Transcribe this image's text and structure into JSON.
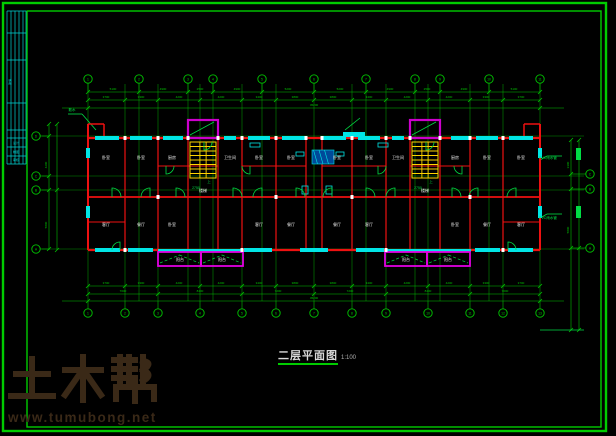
{
  "title": {
    "text": "二层平面图",
    "scale": "1:100"
  },
  "watermark": {
    "brand": "土木帮",
    "url": "www.tumubong.net",
    "color": "#3a2917"
  },
  "colors": {
    "frame": "#00cc00",
    "axis": "#00a800",
    "dim": "#00c400",
    "wall": "#ee1111",
    "window": "#00e5e5",
    "stair": "#ffd400",
    "shaft": "#cc00cc",
    "balcony": "#e000e0",
    "label": "#e8e8e8",
    "anno": "#00dd44",
    "titleblock": "#00d5d5",
    "hatch_fill": "#004a99"
  },
  "frame": {
    "outer": [
      3,
      3,
      603,
      428
    ],
    "inner": [
      27,
      11,
      574,
      416
    ]
  },
  "titleblock": {
    "x1": 7,
    "x2": 26,
    "vx": [
      7,
      11,
      15,
      19,
      23,
      26
    ],
    "hy": [
      11,
      33,
      60,
      103,
      130,
      138,
      147,
      156,
      164
    ],
    "texts": [
      {
        "x": 16,
        "y": 144,
        "t": "设计"
      },
      {
        "x": 16,
        "y": 153,
        "t": "制图"
      },
      {
        "x": 16,
        "y": 161,
        "t": "审核"
      },
      {
        "x": 11,
        "y": 82,
        "t": "建施",
        "rot": -90
      }
    ]
  },
  "axes": {
    "v": [
      88,
      125,
      139,
      158,
      188,
      200,
      213,
      242,
      262,
      276,
      314,
      352,
      366,
      386,
      415,
      428,
      440,
      470,
      489,
      503,
      540
    ],
    "v_y1": 84,
    "v_y2": 301,
    "h": [
      136,
      176,
      190,
      249
    ],
    "h_x1": 42,
    "h_x2": 584
  },
  "bubbles": {
    "top": {
      "cy": 79,
      "x": [
        88,
        139,
        188,
        213,
        262,
        314,
        366,
        415,
        440,
        489,
        540
      ],
      "n": [
        "1",
        "2",
        "3",
        "4",
        "5",
        "6",
        "7",
        "8",
        "9",
        "10",
        "11"
      ]
    },
    "bottom": {
      "cy": 313,
      "x": [
        88,
        125,
        158,
        200,
        242,
        276,
        314,
        352,
        386,
        428,
        470,
        503,
        540
      ],
      "n": [
        "1",
        "2",
        "3",
        "4",
        "5",
        "6",
        "7",
        "8",
        "9",
        "10",
        "11",
        "12",
        "13"
      ]
    },
    "left": {
      "cx": 36,
      "y": [
        136,
        176,
        190,
        249
      ],
      "n": [
        "D",
        "C",
        "B",
        "A"
      ]
    },
    "right": {
      "cx": 590,
      "y": [
        174,
        189,
        248
      ],
      "n": [
        "C",
        "B",
        "A"
      ]
    }
  },
  "dims": {
    "h": [
      {
        "y": 92,
        "x1": 88,
        "x2": 540,
        "ticks": [
          88,
          139,
          188,
          213,
          262,
          314,
          366,
          415,
          440,
          489,
          540
        ]
      },
      {
        "y": 100,
        "x1": 88,
        "x2": 540,
        "ticks": [
          88,
          125,
          158,
          200,
          242,
          276,
          314,
          352,
          386,
          428,
          470,
          503,
          540
        ]
      },
      {
        "y": 108,
        "x1": 62,
        "x2": 564,
        "ticks": [
          88,
          540
        ]
      },
      {
        "y": 286,
        "x1": 88,
        "x2": 540,
        "ticks": [
          88,
          125,
          158,
          200,
          242,
          276,
          314,
          352,
          386,
          428,
          470,
          503,
          540
        ]
      },
      {
        "y": 294,
        "x1": 88,
        "x2": 540,
        "ticks": [
          88,
          158,
          242,
          314,
          386,
          470,
          540
        ]
      },
      {
        "y": 301,
        "x1": 62,
        "x2": 564,
        "ticks": [
          88,
          540
        ]
      }
    ],
    "v": [
      {
        "x": 49,
        "y1": 124,
        "y2": 250,
        "ticks": [
          124,
          136,
          176,
          190,
          249
        ]
      },
      {
        "x": 57,
        "y1": 124,
        "y2": 250,
        "ticks": [
          124,
          190,
          250
        ]
      },
      {
        "x": 571,
        "y1": 140,
        "y2": 330,
        "ticks": [
          140,
          174,
          189,
          248,
          330
        ]
      },
      {
        "x": 579,
        "y1": 140,
        "y2": 330,
        "ticks": [
          140,
          248,
          330
        ]
      }
    ],
    "texts": [
      {
        "x": 113,
        "y": 90,
        "t": "5100"
      },
      {
        "x": 163,
        "y": 90,
        "t": "4900"
      },
      {
        "x": 200,
        "y": 90,
        "t": "2500"
      },
      {
        "x": 237,
        "y": 90,
        "t": "4900"
      },
      {
        "x": 288,
        "y": 90,
        "t": "5200"
      },
      {
        "x": 340,
        "y": 90,
        "t": "5200"
      },
      {
        "x": 390,
        "y": 90,
        "t": "4900"
      },
      {
        "x": 427,
        "y": 90,
        "t": "2500"
      },
      {
        "x": 464,
        "y": 90,
        "t": "4900"
      },
      {
        "x": 514,
        "y": 90,
        "t": "5100"
      },
      {
        "x": 106,
        "y": 98,
        "t": "3700"
      },
      {
        "x": 141,
        "y": 98,
        "t": "3300"
      },
      {
        "x": 179,
        "y": 98,
        "t": "4200"
      },
      {
        "x": 221,
        "y": 98,
        "t": "4200"
      },
      {
        "x": 259,
        "y": 98,
        "t": "3400"
      },
      {
        "x": 295,
        "y": 98,
        "t": "3800"
      },
      {
        "x": 333,
        "y": 98,
        "t": "3800"
      },
      {
        "x": 369,
        "y": 98,
        "t": "3400"
      },
      {
        "x": 407,
        "y": 98,
        "t": "4200"
      },
      {
        "x": 449,
        "y": 98,
        "t": "4200"
      },
      {
        "x": 486,
        "y": 98,
        "t": "3300"
      },
      {
        "x": 521,
        "y": 98,
        "t": "3700"
      },
      {
        "x": 314,
        "y": 106,
        "t": "45200"
      },
      {
        "x": 106,
        "y": 284,
        "t": "3700"
      },
      {
        "x": 141,
        "y": 284,
        "t": "3300"
      },
      {
        "x": 179,
        "y": 284,
        "t": "4200"
      },
      {
        "x": 221,
        "y": 284,
        "t": "4200"
      },
      {
        "x": 259,
        "y": 284,
        "t": "3400"
      },
      {
        "x": 295,
        "y": 284,
        "t": "3800"
      },
      {
        "x": 333,
        "y": 284,
        "t": "3800"
      },
      {
        "x": 369,
        "y": 284,
        "t": "3400"
      },
      {
        "x": 407,
        "y": 284,
        "t": "4200"
      },
      {
        "x": 449,
        "y": 284,
        "t": "4200"
      },
      {
        "x": 486,
        "y": 284,
        "t": "3300"
      },
      {
        "x": 521,
        "y": 284,
        "t": "3700"
      },
      {
        "x": 123,
        "y": 292,
        "t": "7000"
      },
      {
        "x": 200,
        "y": 292,
        "t": "8400"
      },
      {
        "x": 278,
        "y": 292,
        "t": "7200"
      },
      {
        "x": 350,
        "y": 292,
        "t": "7200"
      },
      {
        "x": 428,
        "y": 292,
        "t": "8400"
      },
      {
        "x": 505,
        "y": 292,
        "t": "7000"
      },
      {
        "x": 314,
        "y": 299,
        "t": "45200"
      },
      {
        "x": 47,
        "y": 165,
        "t": "4200",
        "rot": -90
      },
      {
        "x": 47,
        "y": 225,
        "t": "5800",
        "rot": -90
      },
      {
        "x": 569,
        "y": 165,
        "t": "3300",
        "rot": -90
      },
      {
        "x": 569,
        "y": 230,
        "t": "5800",
        "rot": -90
      }
    ]
  },
  "walls": [
    [
      88,
      124,
      88,
      250,
      2
    ],
    [
      540,
      124,
      540,
      250,
      2
    ],
    [
      88,
      250,
      540,
      250,
      2.2
    ],
    [
      88,
      138,
      540,
      138,
      2.2
    ],
    [
      88,
      124,
      104,
      124,
      1.5
    ],
    [
      104,
      124,
      104,
      138,
      1.5
    ],
    [
      524,
      124,
      540,
      124,
      1.5
    ],
    [
      524,
      124,
      524,
      138,
      1.5
    ],
    [
      88,
      197,
      540,
      197,
      1.8
    ],
    [
      125,
      138,
      125,
      250,
      1.2
    ],
    [
      158,
      138,
      158,
      250,
      1.2
    ],
    [
      188,
      138,
      188,
      250,
      1.2
    ],
    [
      218,
      138,
      218,
      250,
      1.2
    ],
    [
      242,
      138,
      242,
      250,
      1.2
    ],
    [
      276,
      138,
      276,
      250,
      1.2
    ],
    [
      306,
      138,
      306,
      250,
      1.2
    ],
    [
      322,
      138,
      322,
      250,
      1.2
    ],
    [
      352,
      138,
      352,
      250,
      1.2
    ],
    [
      386,
      138,
      386,
      250,
      1.2
    ],
    [
      410,
      138,
      410,
      250,
      1.2
    ],
    [
      440,
      138,
      440,
      250,
      1.2
    ],
    [
      470,
      138,
      470,
      250,
      1.2
    ],
    [
      503,
      138,
      503,
      250,
      1.2
    ],
    [
      158,
      166,
      218,
      166,
      1
    ],
    [
      242,
      166,
      306,
      166,
      1
    ],
    [
      322,
      166,
      386,
      166,
      1
    ],
    [
      410,
      166,
      470,
      166,
      1
    ],
    [
      88,
      222,
      125,
      222,
      1
    ],
    [
      503,
      222,
      540,
      222,
      1
    ]
  ],
  "windows": [
    [
      95,
      136,
      24,
      4
    ],
    [
      130,
      136,
      22,
      4
    ],
    [
      163,
      136,
      20,
      4
    ],
    [
      224,
      136,
      12,
      4
    ],
    [
      248,
      136,
      22,
      4
    ],
    [
      282,
      136,
      24,
      4
    ],
    [
      322,
      136,
      24,
      4
    ],
    [
      358,
      136,
      22,
      4
    ],
    [
      392,
      136,
      12,
      4
    ],
    [
      451,
      136,
      20,
      4
    ],
    [
      476,
      136,
      22,
      4
    ],
    [
      509,
      136,
      24,
      4
    ],
    [
      343,
      132,
      22,
      5
    ],
    [
      95,
      248,
      25,
      4
    ],
    [
      128,
      248,
      25,
      4
    ],
    [
      244,
      248,
      28,
      4
    ],
    [
      300,
      248,
      28,
      4
    ],
    [
      356,
      248,
      28,
      4
    ],
    [
      475,
      248,
      25,
      4
    ],
    [
      508,
      248,
      25,
      4
    ],
    [
      158,
      249,
      85,
      3
    ],
    [
      386,
      249,
      85,
      3
    ],
    [
      86,
      148,
      4,
      10
    ],
    [
      86,
      206,
      4,
      12
    ],
    [
      538,
      148,
      4,
      10
    ],
    [
      538,
      206,
      4,
      12
    ]
  ],
  "shafts": [
    {
      "x": 188,
      "y": 120,
      "w": 30,
      "h": 18
    },
    {
      "x": 410,
      "y": 120,
      "w": 30,
      "h": 18
    }
  ],
  "stairs": [
    {
      "x": 190,
      "y": 142,
      "w": 26,
      "h": 36,
      "n": 8
    },
    {
      "x": 412,
      "y": 142,
      "w": 26,
      "h": 36,
      "n": 8
    }
  ],
  "balconies": [
    {
      "x": 158,
      "y": 252,
      "w": 43,
      "h": 14
    },
    {
      "x": 201,
      "y": 252,
      "w": 42,
      "h": 14
    },
    {
      "x": 385,
      "y": 252,
      "w": 42,
      "h": 14
    },
    {
      "x": 427,
      "y": 252,
      "w": 43,
      "h": 14
    }
  ],
  "doors": [
    [
      112,
      197,
      9,
      1,
      -1
    ],
    [
      150,
      197,
      9,
      -1,
      -1
    ],
    [
      176,
      197,
      9,
      1,
      -1
    ],
    [
      233,
      197,
      9,
      1,
      -1
    ],
    [
      262,
      197,
      9,
      -1,
      -1
    ],
    [
      296,
      197,
      9,
      1,
      -1
    ],
    [
      332,
      197,
      9,
      -1,
      -1
    ],
    [
      366,
      197,
      9,
      1,
      -1
    ],
    [
      395,
      197,
      9,
      -1,
      -1
    ],
    [
      452,
      197,
      9,
      1,
      -1
    ],
    [
      478,
      197,
      9,
      -1,
      -1
    ],
    [
      516,
      197,
      9,
      -1,
      -1
    ],
    [
      166,
      166,
      8,
      1,
      1
    ],
    [
      250,
      166,
      8,
      -1,
      1
    ],
    [
      378,
      166,
      8,
      1,
      1
    ],
    [
      462,
      166,
      8,
      -1,
      1
    ],
    [
      204,
      142,
      8,
      1,
      1
    ],
    [
      426,
      142,
      8,
      1,
      1
    ],
    [
      120,
      250,
      8,
      -1,
      -1
    ],
    [
      508,
      250,
      8,
      1,
      -1
    ]
  ],
  "hatches": [
    {
      "x": 312,
      "y": 150,
      "w": 22,
      "h": 14
    }
  ],
  "fixtures": [
    [
      296,
      152,
      8,
      4
    ],
    [
      336,
      152,
      8,
      4
    ],
    [
      250,
      143,
      10,
      4
    ],
    [
      378,
      143,
      10,
      4
    ],
    [
      302,
      186,
      6,
      8
    ],
    [
      326,
      186,
      6,
      8
    ]
  ],
  "green_rects": [
    [
      576,
      148,
      5,
      12
    ],
    [
      576,
      206,
      5,
      12
    ]
  ],
  "white_dots": {
    "y138": [
      125,
      158,
      188,
      218,
      242,
      276,
      306,
      322,
      352,
      386,
      410,
      440,
      470,
      503
    ],
    "y250": [
      125,
      242,
      386,
      503
    ],
    "y197": [
      158,
      276,
      352,
      470
    ]
  },
  "labels": [
    {
      "x": 106,
      "y": 159,
      "t": "卧室"
    },
    {
      "x": 141,
      "y": 159,
      "t": "卧室"
    },
    {
      "x": 172,
      "y": 159,
      "t": "厨房"
    },
    {
      "x": 230,
      "y": 159,
      "t": "卫生间"
    },
    {
      "x": 259,
      "y": 159,
      "t": "卧室"
    },
    {
      "x": 291,
      "y": 159,
      "t": "卧室"
    },
    {
      "x": 337,
      "y": 159,
      "t": "卧室"
    },
    {
      "x": 369,
      "y": 159,
      "t": "卧室"
    },
    {
      "x": 398,
      "y": 159,
      "t": "卫生间"
    },
    {
      "x": 455,
      "y": 159,
      "t": "厨房"
    },
    {
      "x": 487,
      "y": 159,
      "t": "卧室"
    },
    {
      "x": 521,
      "y": 159,
      "t": "卧室"
    },
    {
      "x": 106,
      "y": 226,
      "t": "客厅"
    },
    {
      "x": 141,
      "y": 226,
      "t": "餐厅"
    },
    {
      "x": 172,
      "y": 226,
      "t": "卧室"
    },
    {
      "x": 259,
      "y": 226,
      "t": "客厅"
    },
    {
      "x": 291,
      "y": 226,
      "t": "餐厅"
    },
    {
      "x": 337,
      "y": 226,
      "t": "餐厅"
    },
    {
      "x": 369,
      "y": 226,
      "t": "客厅"
    },
    {
      "x": 455,
      "y": 226,
      "t": "卧室"
    },
    {
      "x": 487,
      "y": 226,
      "t": "餐厅"
    },
    {
      "x": 521,
      "y": 226,
      "t": "客厅"
    },
    {
      "x": 203,
      "y": 192,
      "t": "楼梯"
    },
    {
      "x": 425,
      "y": 192,
      "t": "楼梯"
    },
    {
      "x": 180,
      "y": 261,
      "t": "阳台"
    },
    {
      "x": 222,
      "y": 261,
      "t": "阳台"
    },
    {
      "x": 406,
      "y": 261,
      "t": "阳台"
    },
    {
      "x": 448,
      "y": 261,
      "t": "阳台"
    }
  ],
  "annos": [
    {
      "x": 548,
      "y": 159,
      "t": "PVC雨水管"
    },
    {
      "x": 548,
      "y": 219,
      "t": "PVC雨水管"
    },
    {
      "x": 196,
      "y": 189,
      "t": "2750"
    },
    {
      "x": 418,
      "y": 189,
      "t": "2750"
    },
    {
      "x": 209,
      "y": 183,
      "t": "上"
    },
    {
      "x": 431,
      "y": 183,
      "t": "上"
    },
    {
      "x": 72,
      "y": 111,
      "t": "散水"
    }
  ],
  "leaders": [
    [
      96,
      130,
      82,
      114,
      68,
      114
    ],
    [
      190,
      135,
      214,
      122
    ],
    [
      412,
      135,
      436,
      122
    ],
    [
      540,
      160,
      547,
      156,
      562,
      156
    ],
    [
      540,
      218,
      547,
      214,
      562,
      214
    ],
    [
      540,
      330,
      584,
      330
    ],
    [
      345,
      130,
      360,
      118
    ]
  ]
}
